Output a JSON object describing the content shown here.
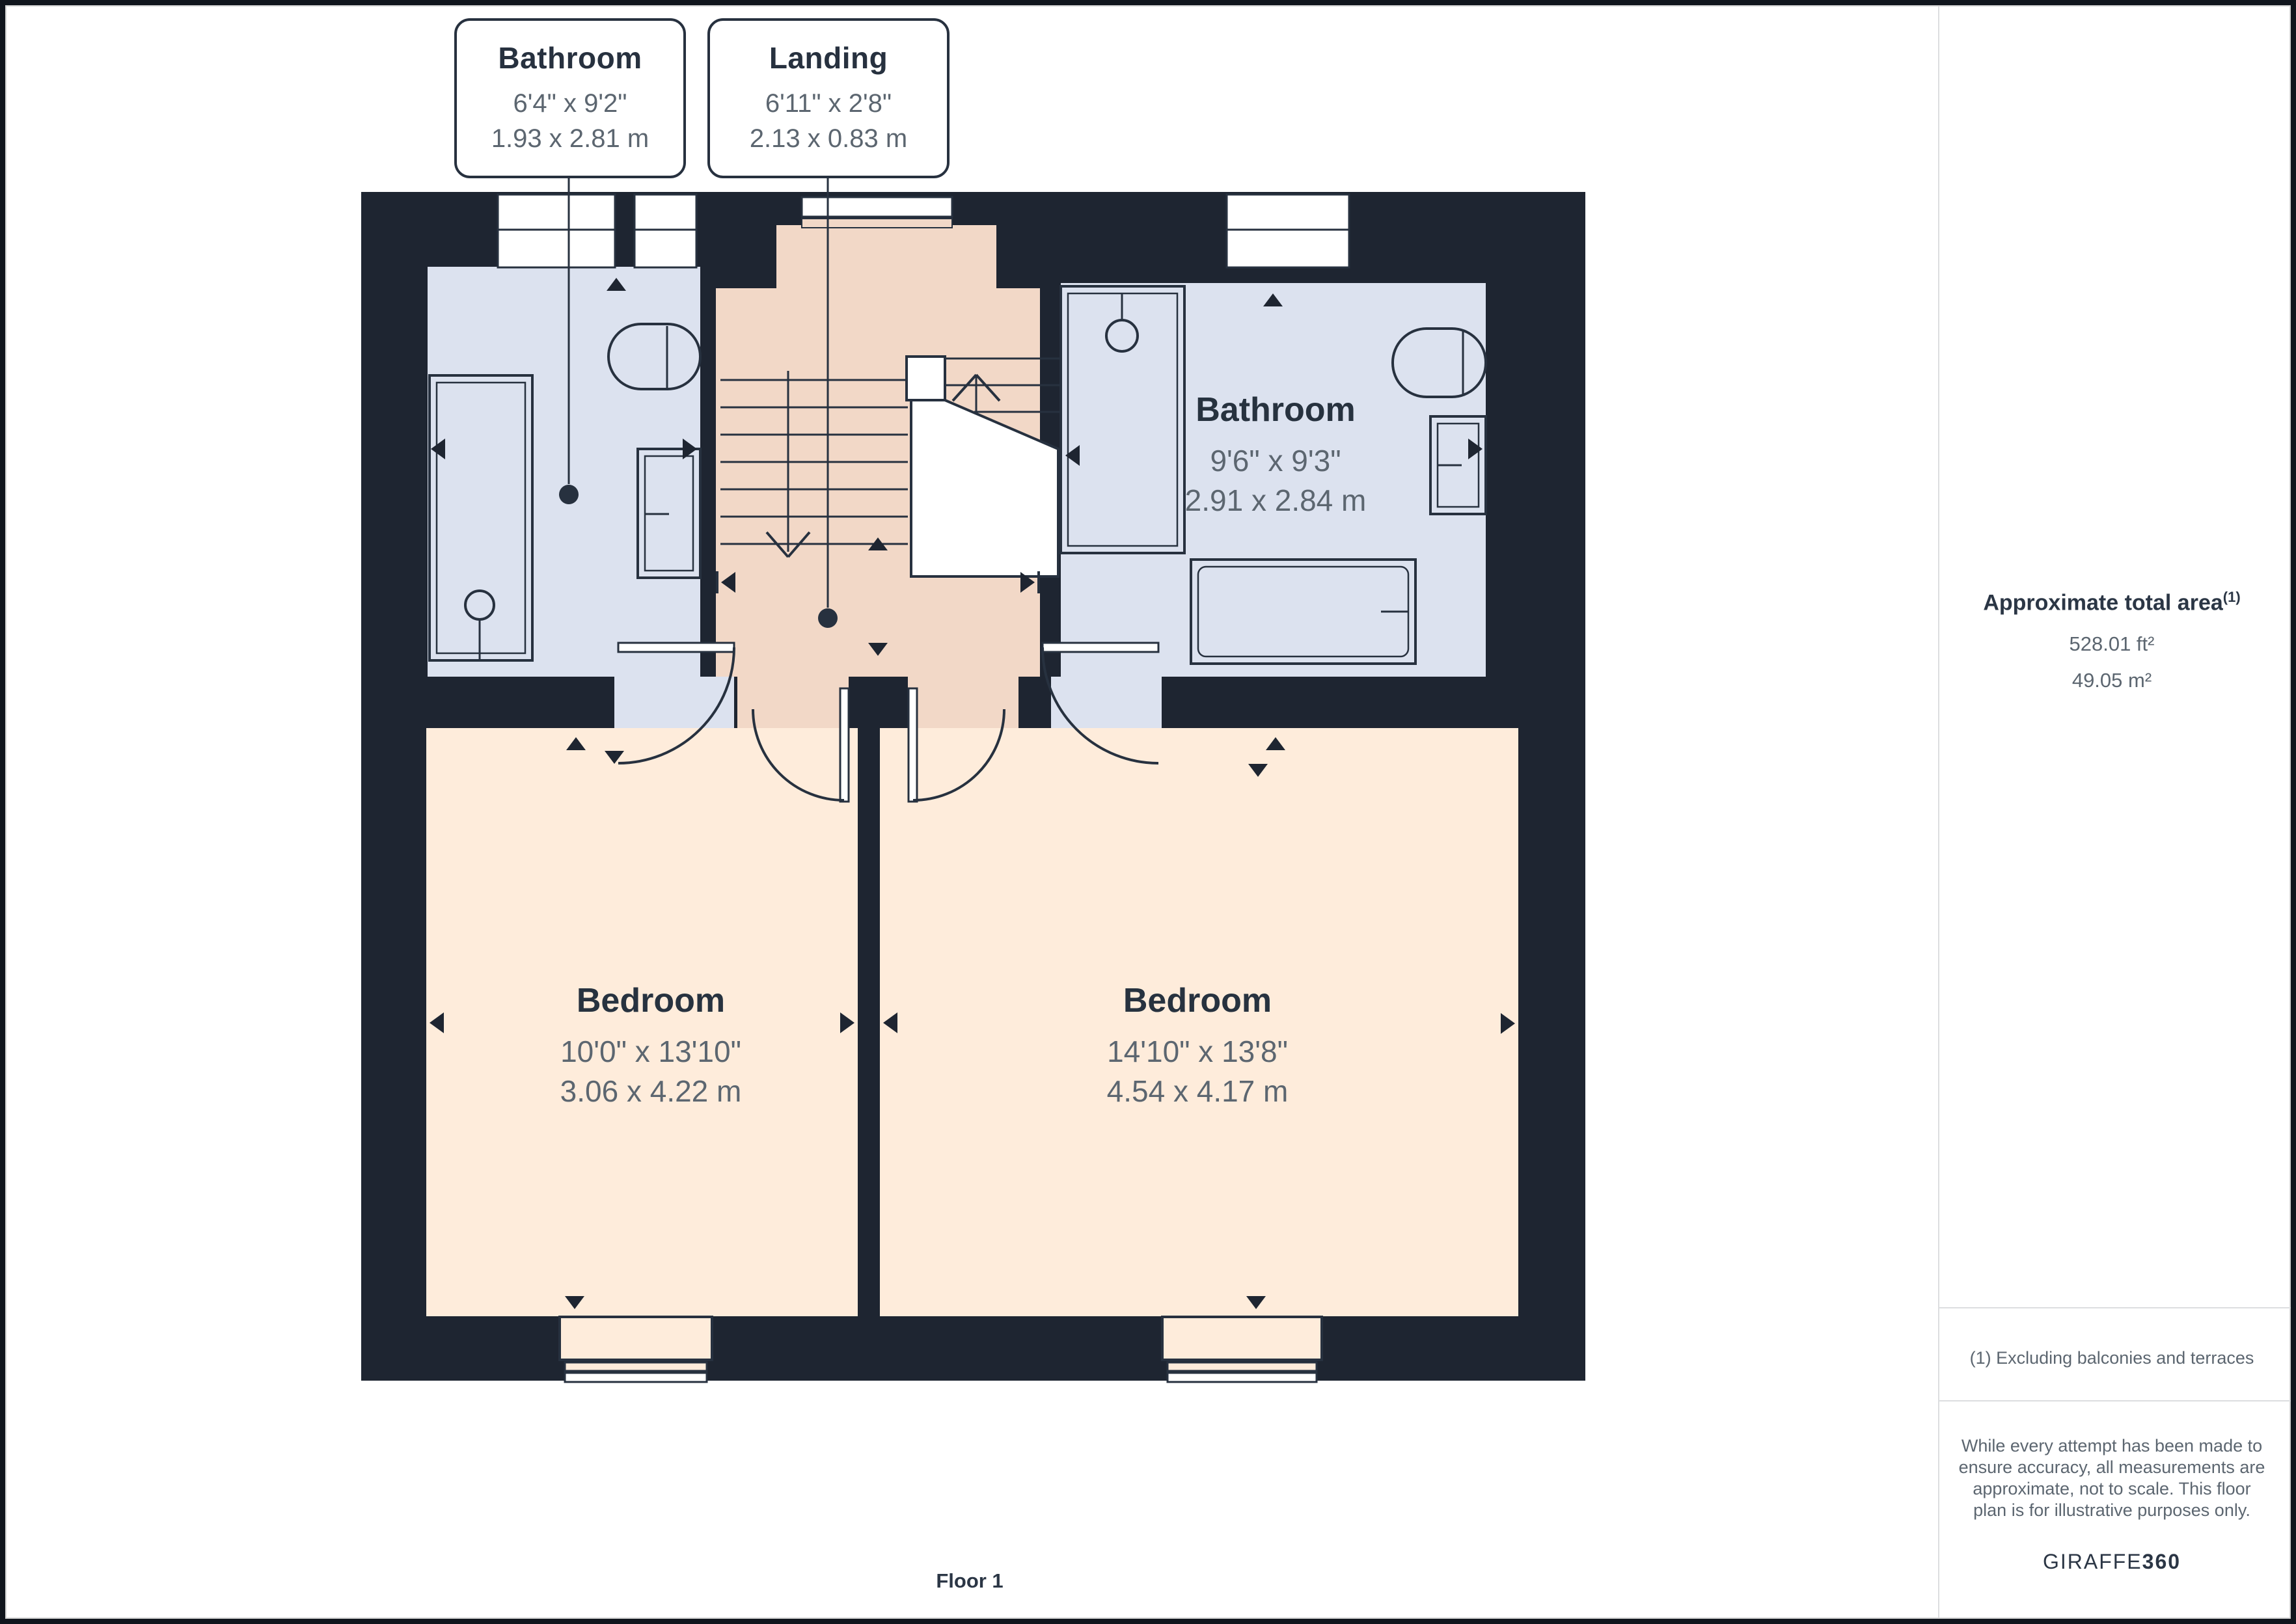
{
  "callouts": [
    {
      "name": "Bathroom",
      "imperial": "6'4\" x 9'2\"",
      "metric": "1.93 x 2.81 m"
    },
    {
      "name": "Landing",
      "imperial": "6'11\" x 2'8\"",
      "metric": "2.13 x 0.83 m"
    }
  ],
  "rooms": [
    {
      "name": "Bathroom",
      "imperial": "9'6\" x 9'3\"",
      "metric": "2.91 x 2.84 m"
    },
    {
      "name": "Bedroom",
      "imperial": "10'0\" x 13'10\"",
      "metric": "3.06 x 4.22 m"
    },
    {
      "name": "Bedroom",
      "imperial": "14'10\" x 13'8\"",
      "metric": "4.54 x 4.17 m"
    }
  ],
  "sidebar": {
    "title": "Approximate total area",
    "footnote_marker": "(1)",
    "area_ft": "528.01 ft²",
    "area_m": "49.05 m²",
    "footnote": "(1) Excluding balconies and terraces",
    "disclaimer_lines": [
      "While every attempt has been made to",
      "ensure accuracy, all measurements are",
      "approximate, not to scale. This floor",
      "plan is for illustrative purposes only."
    ],
    "brand": "GIRAFFE",
    "brand_suffix": "360"
  },
  "footer": {
    "floor_label": "Floor 1"
  },
  "colors": {
    "wall": "#1e2531",
    "bathroom_floor": "#dce2ef",
    "landing_floor": "#f2d8c7",
    "bedroom_floor": "#feecdb",
    "line": "#27313f",
    "white": "#ffffff"
  }
}
